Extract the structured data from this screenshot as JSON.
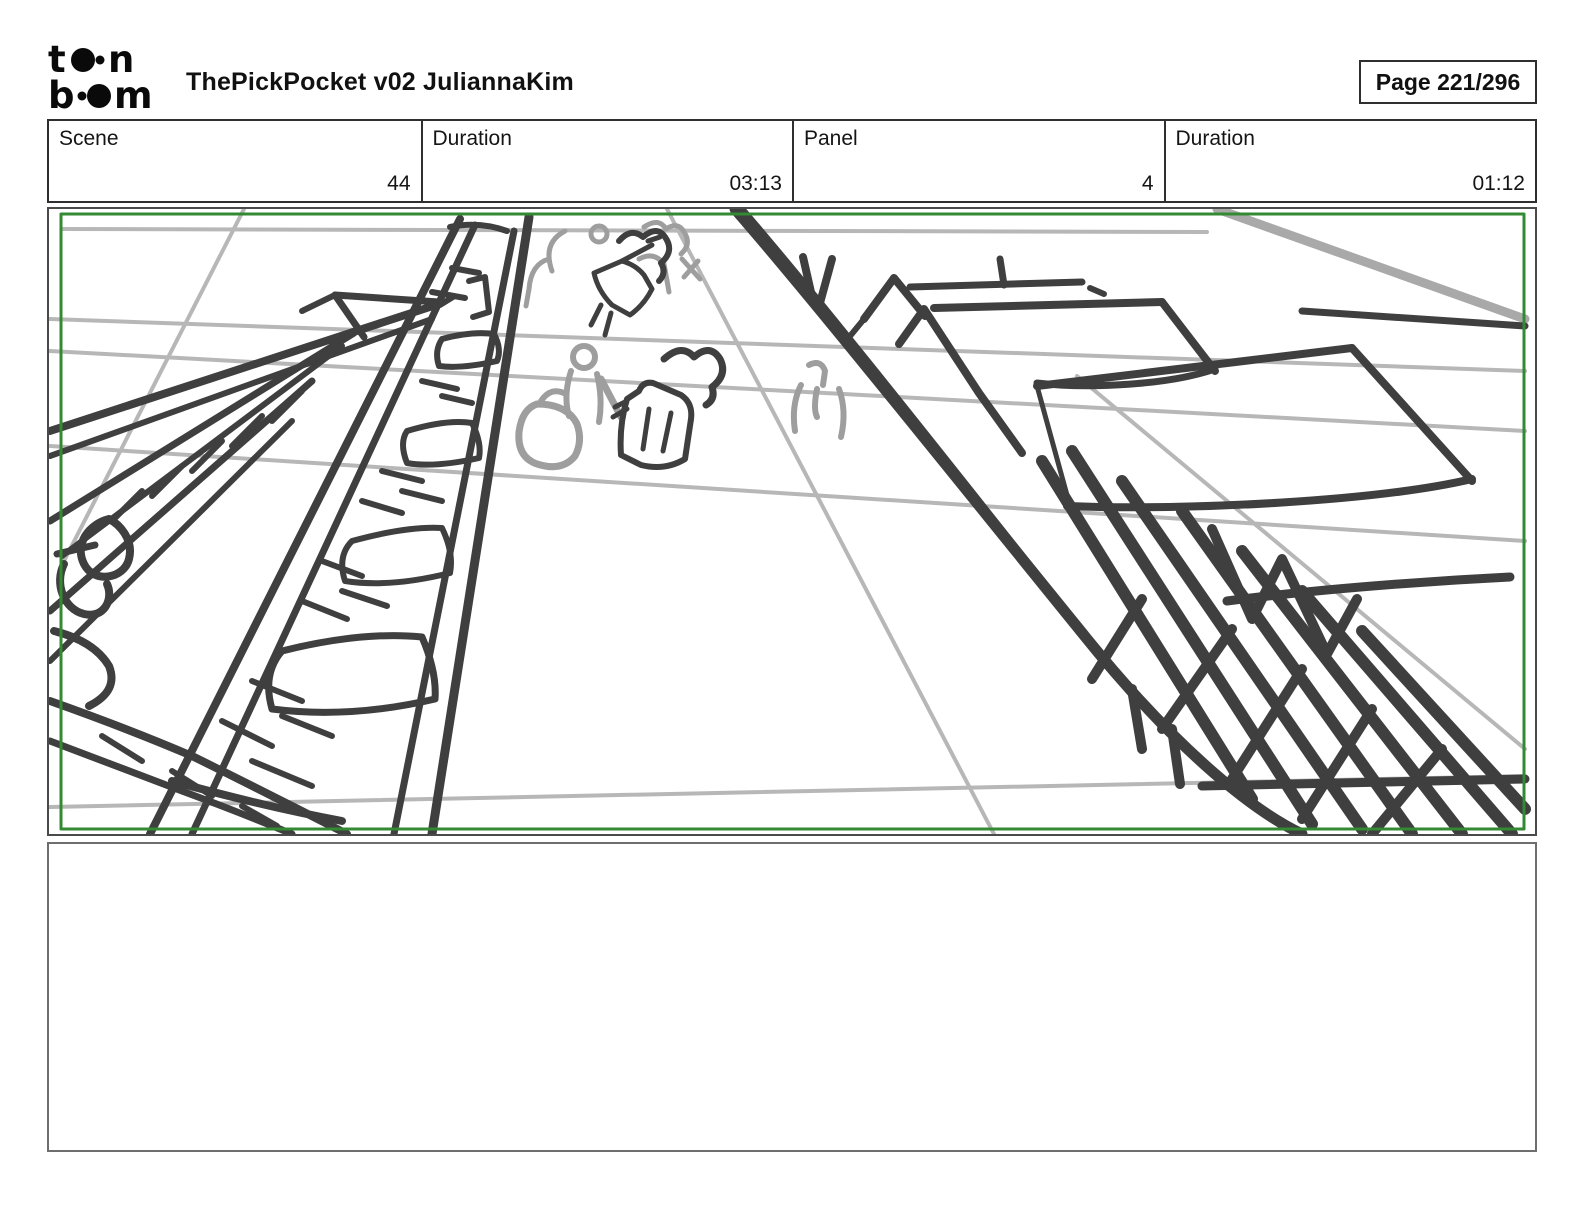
{
  "header": {
    "logo": {
      "alt": "toon boom",
      "top_letter_1": "t",
      "top_letter_2": "n",
      "bottom_letter_1": "b",
      "bottom_letter_2": "m"
    },
    "title": "ThePickPocket v02 JuliannaKim",
    "page_label": "Page 221/296"
  },
  "metadata": {
    "cells": [
      {
        "label": "Scene",
        "value": "44"
      },
      {
        "label": "Duration",
        "value": "03:13"
      },
      {
        "label": "Panel",
        "value": "4"
      },
      {
        "label": "Duration",
        "value": "01:12"
      }
    ]
  },
  "notes": {
    "text": ""
  },
  "colors": {
    "frame-green": "#338a33",
    "sketch-dark": "#3f3f3f",
    "sketch-light": "#b7b7b7",
    "sketch-midgray": "#9e9e9e",
    "coat-fill": "#d4d4d4",
    "border-dark": "#2f2f2f",
    "panel-border": "#4a4a4a",
    "notes-border": "#6e6e6e"
  }
}
